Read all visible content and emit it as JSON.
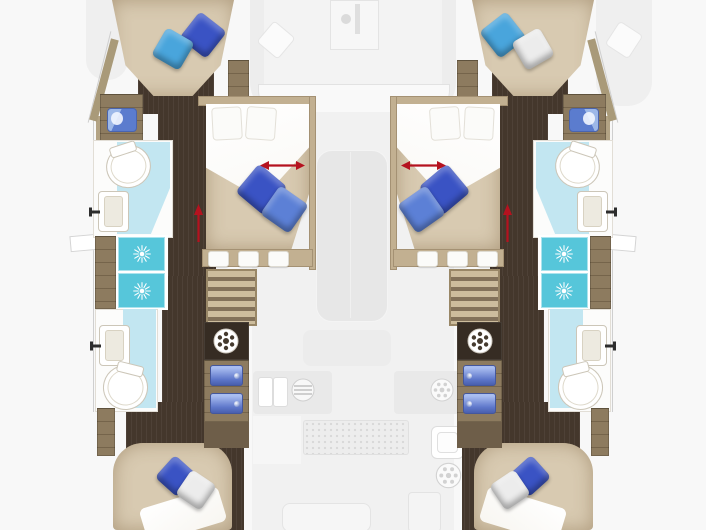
{
  "floorplan": {
    "type": "catamaran-yacht-deck-plan",
    "view": "top-down",
    "orientation": "bow-up",
    "hulls": [
      "port",
      "starboard"
    ],
    "port_hull": {
      "forward_cabin": {
        "bed": "v-berth-double",
        "pillows": [
          "dark-blue",
          "light-blue"
        ]
      },
      "forward_head": {
        "fixtures": [
          "toilet",
          "sink-with-faucet",
          "vanity-sink"
        ]
      },
      "midship_cabin": {
        "bed": "island-double",
        "pillows": [
          "white",
          "white",
          "dark-blue",
          "medium-blue"
        ],
        "indicator": "red-slide-arrow"
      },
      "shower_room": {
        "stalls": 2,
        "icon": "shower-spray"
      },
      "aft_head": {
        "fixtures": [
          "sink-with-faucet",
          "toilet"
        ]
      },
      "aft_cabin": {
        "bed": "double",
        "pillows": [
          "dark-blue",
          "white"
        ]
      },
      "utilities": [
        "companionway-stairs",
        "washing-machine",
        "drawer-unit",
        "drawer-unit"
      ],
      "indicator": "red-up-arrow"
    },
    "starboard_hull": {
      "forward_cabin": {
        "bed": "v-berth-double",
        "pillows": [
          "light-blue",
          "white"
        ]
      },
      "forward_head": {
        "fixtures": [
          "toilet",
          "sink-with-faucet",
          "vanity-sink"
        ]
      },
      "midship_cabin": {
        "bed": "island-double",
        "pillows": [
          "white",
          "white",
          "dark-blue",
          "medium-blue"
        ],
        "indicator": "red-slide-arrow"
      },
      "shower_room": {
        "stalls": 2,
        "icon": "shower-spray"
      },
      "aft_head": {
        "fixtures": [
          "sink-with-faucet",
          "toilet"
        ]
      },
      "aft_cabin": {
        "bed": "double",
        "pillows": [
          "dark-blue",
          "white"
        ]
      },
      "utilities": [
        "companionway-stairs",
        "washing-machine",
        "drawer-unit",
        "drawer-unit"
      ],
      "indicator": "red-up-arrow"
    },
    "center_deck_ghosted": {
      "foredeck": [
        "anchor-locker",
        "bow-seating",
        "white-pillow-left",
        "white-pillow-right"
      ],
      "salon": [
        "table",
        "bench"
      ],
      "galley": [
        "double-sink",
        "grill-burner",
        "ring-burner",
        "square-sink",
        "ring-burner"
      ],
      "cockpit": [
        "floor-grating",
        "companionway",
        "fridge",
        "cockpit-table"
      ]
    }
  },
  "colors": {
    "background": "#f8f8f8",
    "ghost": "#ededed",
    "hull_floor_dark": "#44372c",
    "wood": "#8d7b5f",
    "wood_light": "#c2b091",
    "bed_tan": "#d8cab1",
    "linen_white": "#f8f6f1",
    "bathroom_floor": "#c2e6f1",
    "shower_teal": "#56c6da",
    "pillow_dark_blue": "#3a53c4",
    "pillow_medium_blue": "#5c80d6",
    "pillow_light_blue": "#49a5dc",
    "pillow_white": "#ececec",
    "arrow_red": "#b5121f",
    "fixture_border": "#ccc6b8"
  }
}
